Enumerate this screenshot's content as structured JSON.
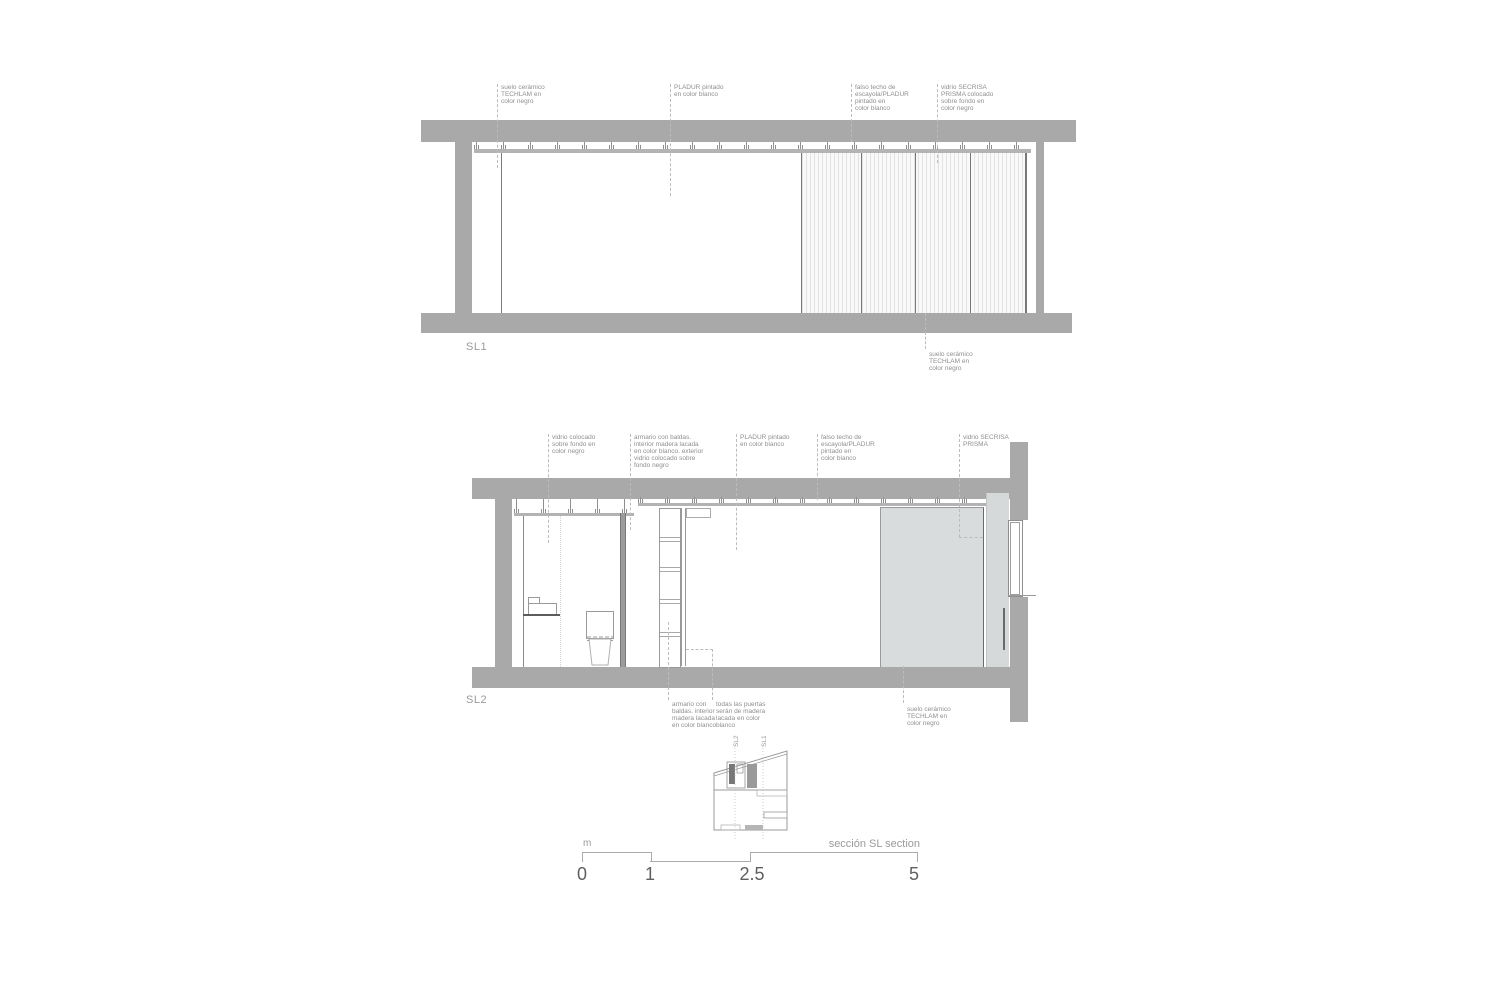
{
  "drawing_title": "sección SL section",
  "colors": {
    "structure_gray": "#a9a9a9",
    "false_ceiling_gray": "#b3b3b3",
    "wardrobe_panel_gray": "#d9dcdc",
    "line_gray": "#787878",
    "annotation_text_gray": "#8f8f8f"
  },
  "sections": {
    "sl1": {
      "label": "SL1",
      "ann_suelo_top": "suelo cerámico\nTECHLAM en\ncolor negro",
      "ann_pladur": "PLADUR pintado\nen color blanco",
      "ann_falso_techo": "falso techo de\nescayola/PLADUR\npintado en\ncolor blanco",
      "ann_vidrio": "vidrio SECRISA\nPRISMA colocado\nsobre fondo en\ncolor negro",
      "ann_suelo_bottom": "suelo cerámico\nTECHLAM en\ncolor negro"
    },
    "sl2": {
      "label": "SL2",
      "ann_vidrio_fondo": "vidrio colocado\nsobre fondo en\ncolor negro",
      "ann_armario_top": "armario con baldas.\ninterior madera lacada\nen color blanco. exterior\nvidrio colocado sobre\nfondo negro",
      "ann_pladur": "PLADUR pintado\nen color blanco",
      "ann_falso_techo": "falso techo de\nescayola/PLADUR\npintado en\ncolor blanco",
      "ann_vidrio_secrisa": "vidrio SECRISA\nPRISMA",
      "ann_armario_bottom": "armario con\nbaldas. interior\nmadera lacada\nen color blanco",
      "ann_puertas": "todas las puertas\nserán de madera\nlacada en color\nblanco",
      "ann_suelo": "suelo cerámico\nTECHLAM en\ncolor negro"
    }
  },
  "keyplan": {
    "sl1_label": "SL1",
    "sl2_label": "SL2"
  },
  "scalebar": {
    "unit": "m",
    "caption": "sección SL section",
    "ticks": [
      "0",
      "1",
      "2.5",
      "5"
    ]
  }
}
